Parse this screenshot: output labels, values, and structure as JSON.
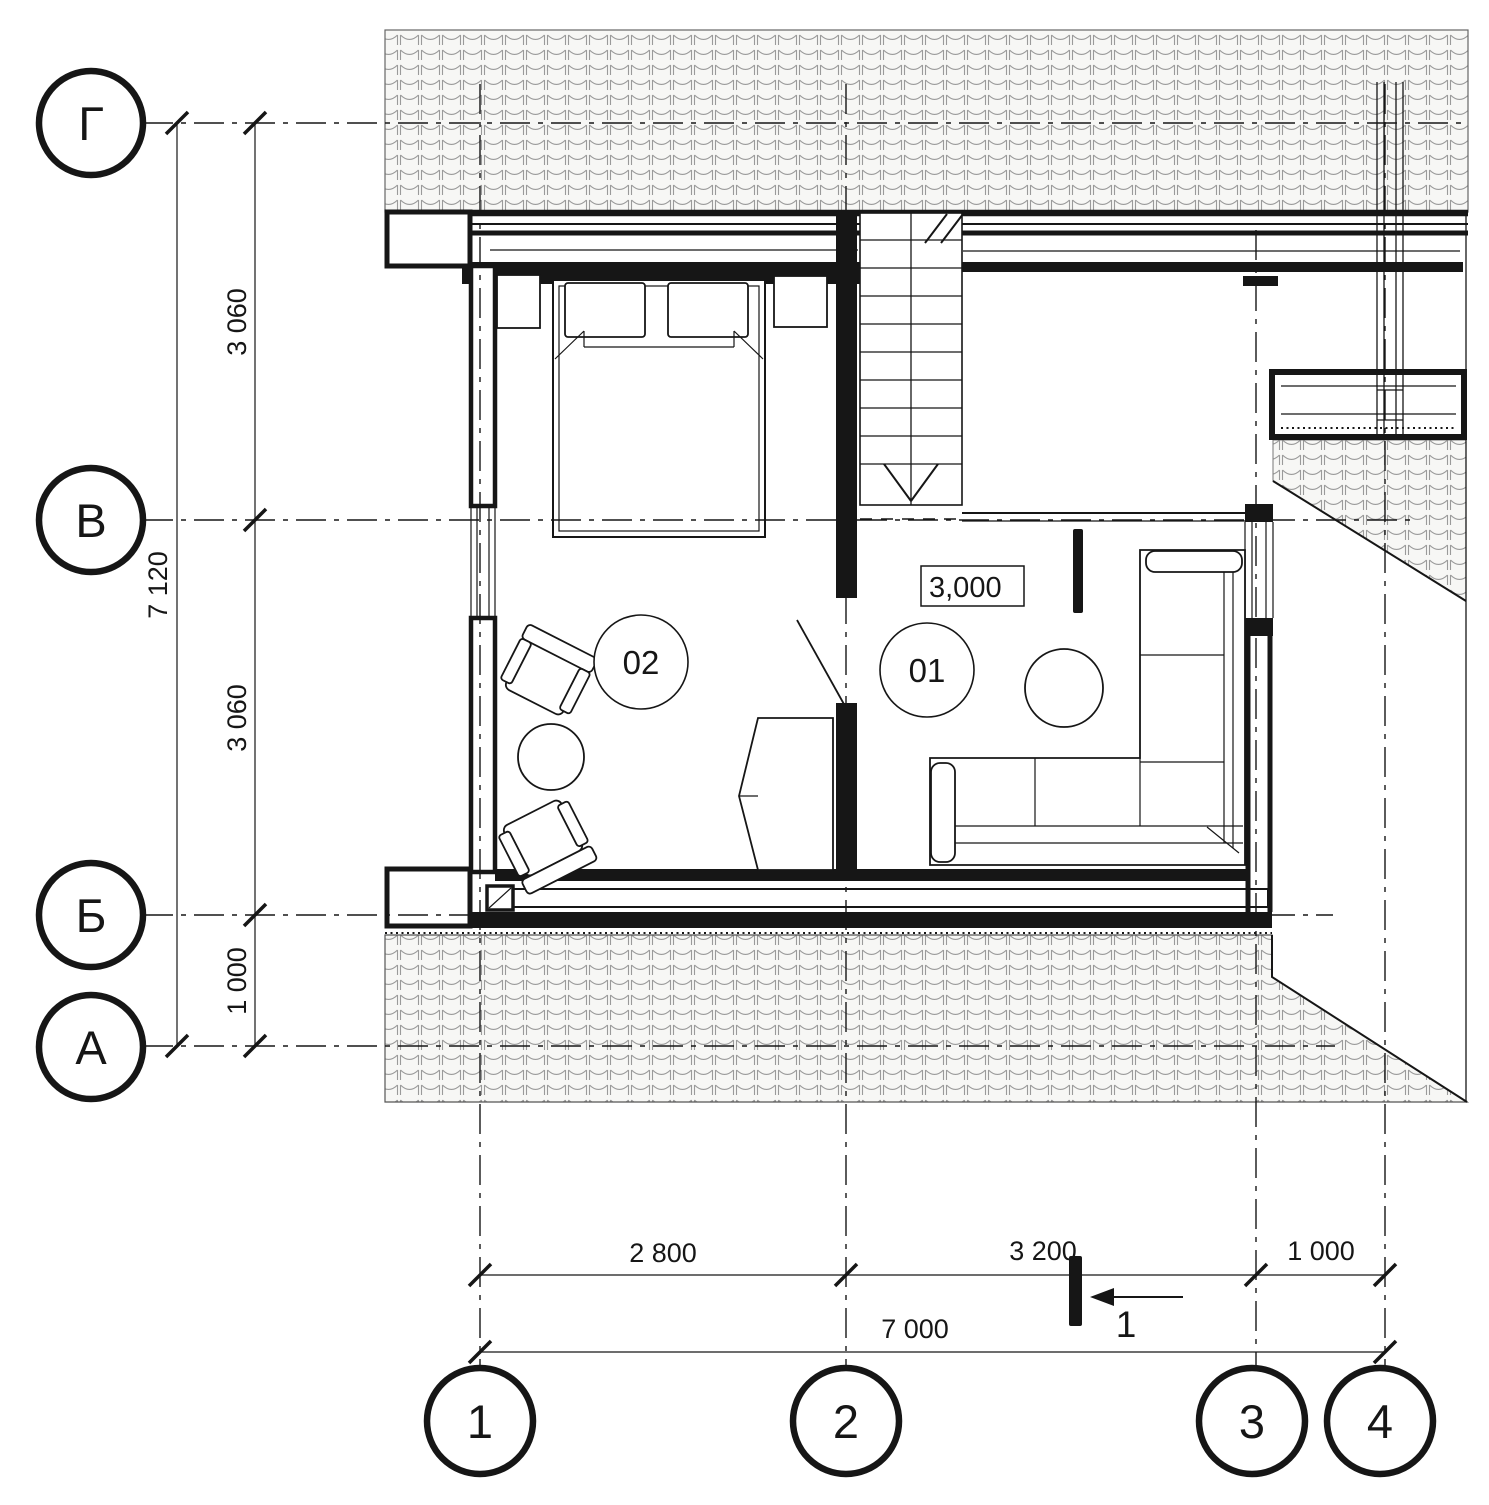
{
  "drawing": {
    "row_axes": [
      {
        "label": "Г"
      },
      {
        "label": "В"
      },
      {
        "label": "Б"
      },
      {
        "label": "А"
      }
    ],
    "col_axes": [
      {
        "label": "1"
      },
      {
        "label": "2"
      },
      {
        "label": "3"
      },
      {
        "label": "4"
      }
    ],
    "dims_left": {
      "seg_gv": "3 060",
      "seg_vb": "3 060",
      "seg_ba": "1 000",
      "total": "7 120"
    },
    "dims_bottom": {
      "seg_12": "2 800",
      "seg_23": "3 200",
      "seg_34": "1 000",
      "total": "7 000"
    },
    "rooms": [
      {
        "number": "01"
      },
      {
        "number": "02"
      }
    ],
    "level_mark": "3,000",
    "section_marker": {
      "label": "1"
    }
  }
}
